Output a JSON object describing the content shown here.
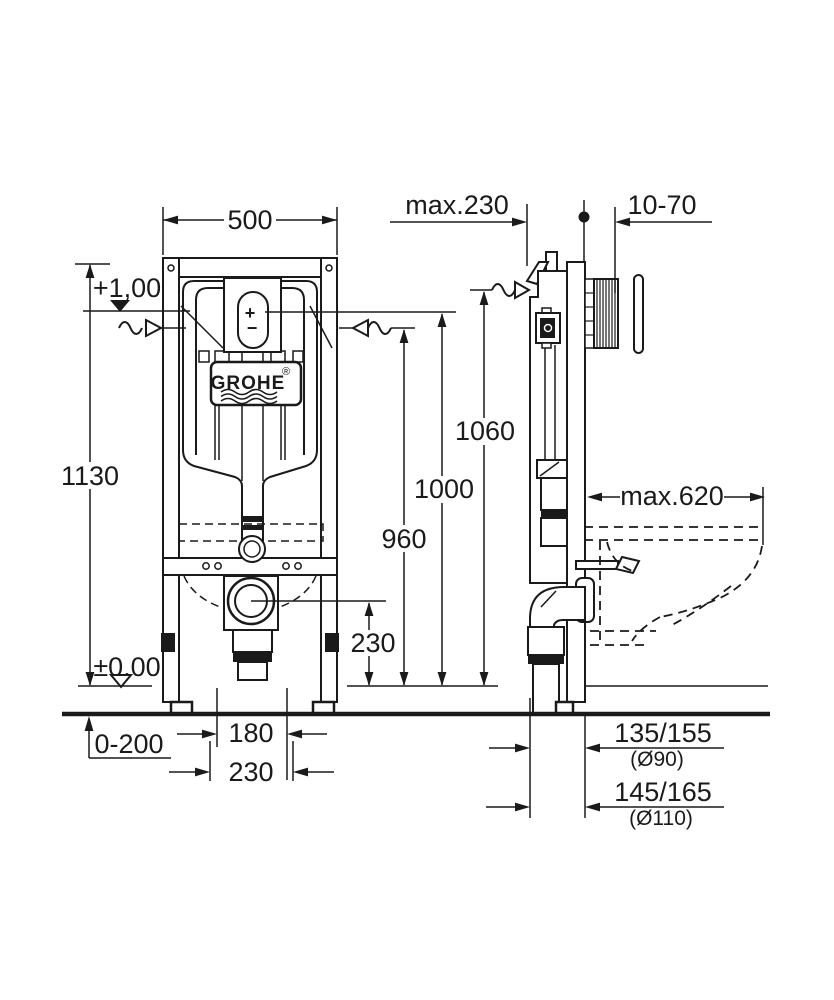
{
  "colors": {
    "line": "#1a1a1a",
    "background": "#ffffff"
  },
  "front_view": {
    "logo": {
      "brand": "GROHE",
      "registered": "®"
    },
    "actuator": {
      "plus": "+",
      "minus": "−"
    }
  },
  "dimensions": {
    "frame_width": "500",
    "install_depth": "max.230",
    "wall_clearance": "10-70",
    "level_top": "+1,00",
    "level_floor": "±0,00",
    "total_height": "1130",
    "height_supply_side": "1060",
    "height_actuation": "1000",
    "height_supply_front": "960",
    "outlet_height": "230",
    "bowl_depth": "max.620",
    "floor_buildup": "0-200",
    "outlet_offset_inner": "180",
    "outlet_offset_outer": "230",
    "drain_offset_90": "135/155",
    "drain_dia_90": "(Ø90)",
    "drain_offset_110": "145/165",
    "drain_dia_110": "(Ø110)"
  }
}
